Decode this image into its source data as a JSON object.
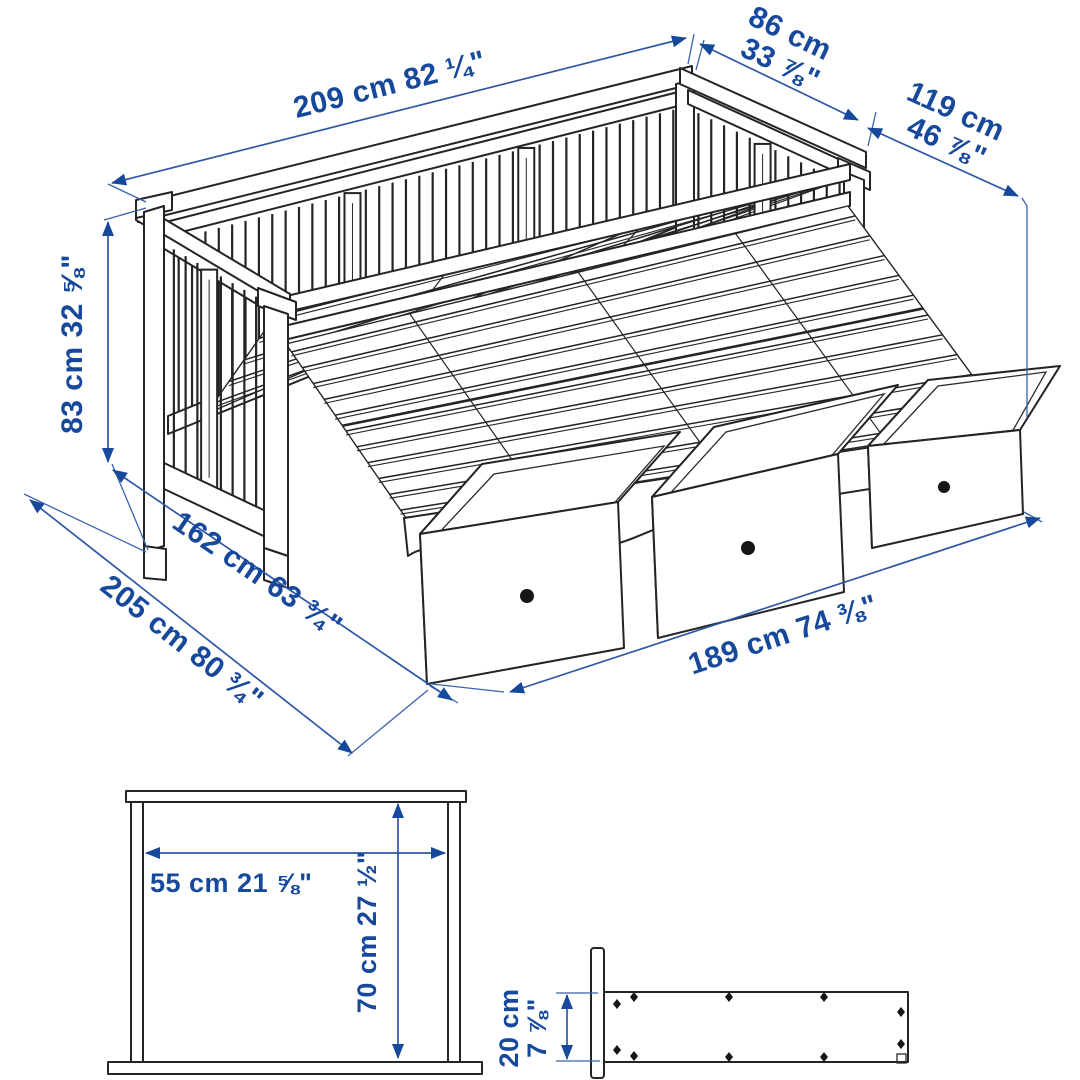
{
  "illustration": {
    "subject": "daybed with three storage drawers, measurement diagram",
    "colors": {
      "dimension_blue": "#16489c",
      "drawing_line": "#242424",
      "background": "#ffffff"
    }
  },
  "dimensions": {
    "bed_length": "209 cm 82 ¼\"",
    "upper_depth": {
      "line1": "86 cm",
      "line2": "33 ⅞\""
    },
    "extended_depth": {
      "line1": "119 cm",
      "line2": "46 ⅞\""
    },
    "height": "83 cm 32 ⅝\"",
    "bed_depth": "162 cm 63 ¾\"",
    "total_depth": "205 cm 80 ¾\"",
    "drawer_span": "189 cm 74 ⅜\"",
    "inner_width": "55 cm 21 ⅝\"",
    "inner_height": "70 cm 27 ½\"",
    "drawer_height": {
      "line1": "20 cm",
      "line2": "7 ⅞\""
    }
  }
}
